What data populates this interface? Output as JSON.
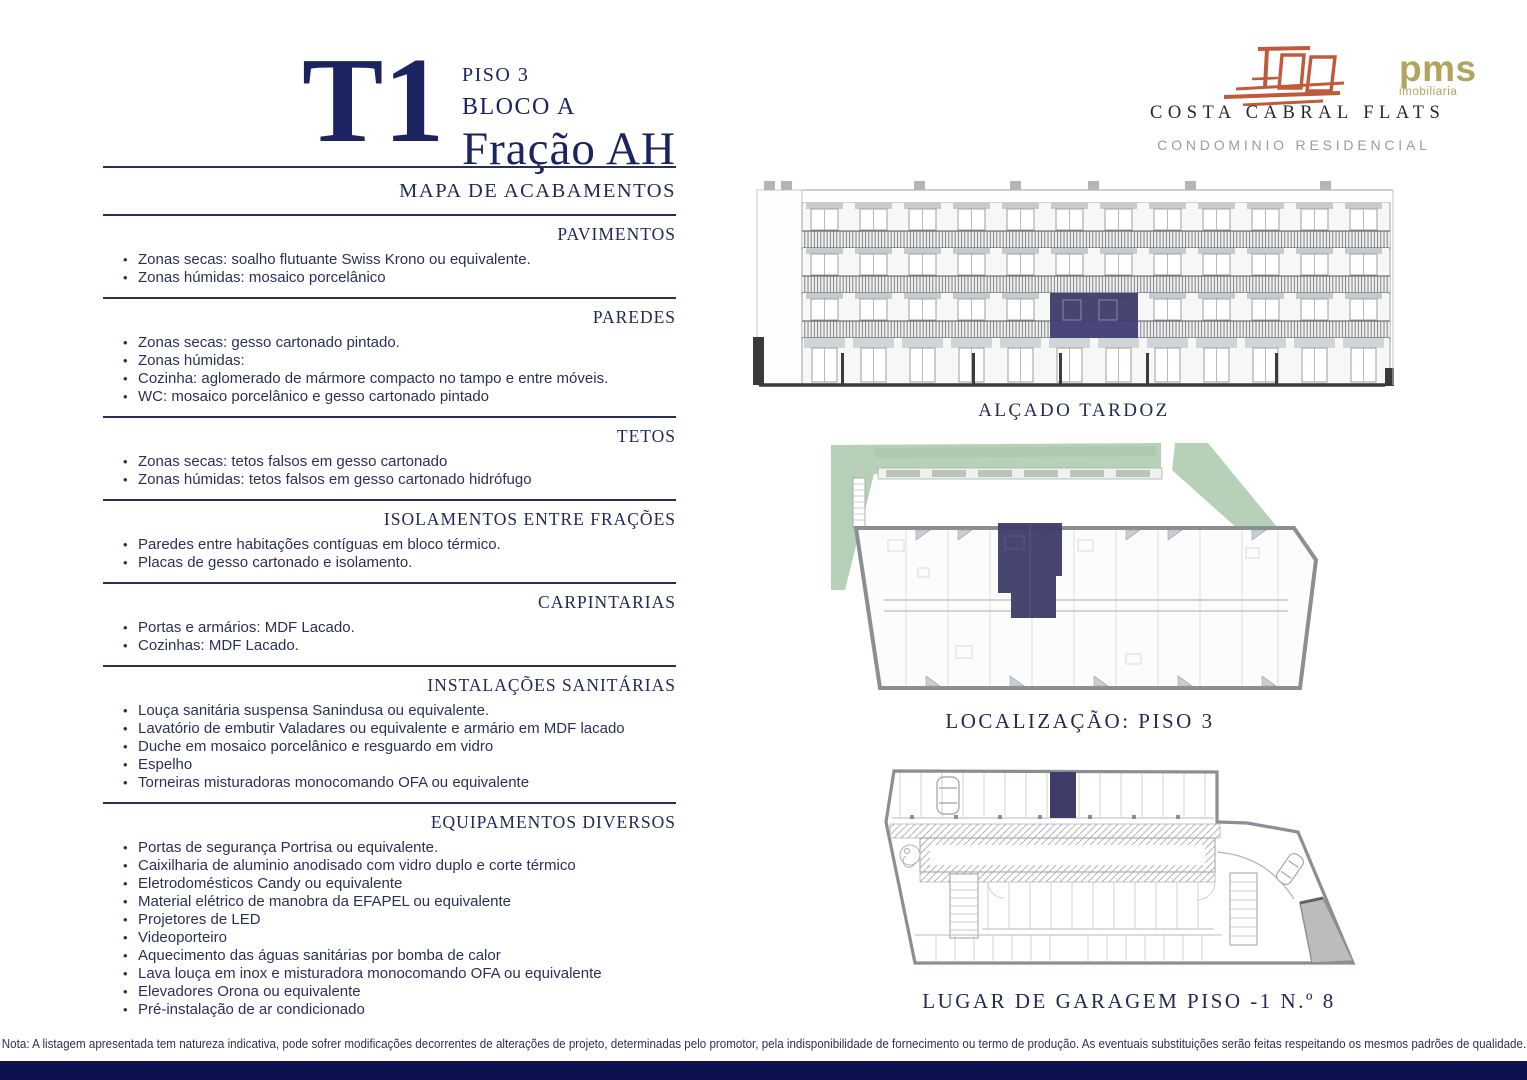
{
  "header": {
    "typology": "T1",
    "floor_label": "PISO 3",
    "block_label": "BLOCO A",
    "fraction_label": "Fração AH",
    "map_title": "MAPA DE ACABAMENTOS"
  },
  "brand": {
    "name": "COSTA CABRAL FLATS",
    "tagline": "CONDOMINIO RESIDENCIAL",
    "agency_name": "pms",
    "agency_tagline": "imobiliaria"
  },
  "sections": [
    {
      "title": "PAVIMENTOS",
      "items": [
        "Zonas secas: soalho flutuante Swiss Krono ou equivalente.",
        "Zonas húmidas: mosaico porcelânico"
      ]
    },
    {
      "title": "PAREDES",
      "items": [
        "Zonas secas: gesso cartonado pintado.",
        "Zonas húmidas:",
        "Cozinha: aglomerado de mármore compacto no tampo e entre móveis.",
        "WC: mosaico porcelânico e gesso cartonado pintado"
      ]
    },
    {
      "title": "TETOS",
      "items": [
        "Zonas secas: tetos falsos em gesso cartonado",
        "Zonas húmidas: tetos falsos em gesso cartonado hidrófugo"
      ]
    },
    {
      "title": "ISOLAMENTOS ENTRE FRAÇÕES",
      "items": [
        "Paredes entre habitações contíguas em bloco térmico.",
        "Placas de gesso cartonado e isolamento."
      ]
    },
    {
      "title": "CARPINTARIAS",
      "items": [
        "Portas e armários: MDF Lacado.",
        "Cozinhas: MDF Lacado."
      ]
    },
    {
      "title": "INSTALAÇÕES SANITÁRIAS",
      "items": [
        "Louça sanitária suspensa Sanindusa ou equivalente.",
        "Lavatório de embutir Valadares ou equivalente e armário em MDF lacado",
        "Duche em mosaico porcelânico e resguardo em vidro",
        "Espelho",
        "Torneiras misturadoras monocomando OFA ou equivalente"
      ]
    },
    {
      "title": "EQUIPAMENTOS DIVERSOS",
      "items": [
        "Portas de segurança Portrisa ou equivalente.",
        "Caixilharia de aluminio anodisado com vidro duplo e corte térmico",
        "Eletrodomésticos Candy ou equivalente",
        "Material elétrico de manobra da EFAPEL ou equivalente",
        "Projetores de LED",
        "Videoporteiro",
        "Aquecimento das águas sanitárias por bomba de calor",
        "Lava louça em inox e misturadora monocomando OFA ou equivalente",
        "Elevadores Orona ou equivalente",
        "Pré-instalação de ar condicionado"
      ]
    }
  ],
  "figures": {
    "elevation": {
      "caption": "ALÇADO TARDOZ"
    },
    "plan": {
      "caption": "LOCALIZAÇÃO: PISO 3"
    },
    "garage": {
      "caption": "LUGAR DE GARAGEM PISO -1 N.º 8"
    }
  },
  "footer": {
    "note": "Nota: A listagem apresentada tem natureza indicativa, pode sofrer modificações decorrentes de alterações de projeto, determinadas pelo promotor, pela indisponibilidade de fornecimento ou termo de produção. As eventuais substituições serão feitas respeitando os mesmos padrões de qualidade."
  },
  "colors": {
    "accent_navy": "#1b2361",
    "highlight_navy": "#3e3c69",
    "logo_terracotta": "#bf5b3a",
    "agency_gold": "#b2a35e",
    "landscape_green": "#b7d1b8",
    "footer_bar_navy": "#0e1150"
  }
}
